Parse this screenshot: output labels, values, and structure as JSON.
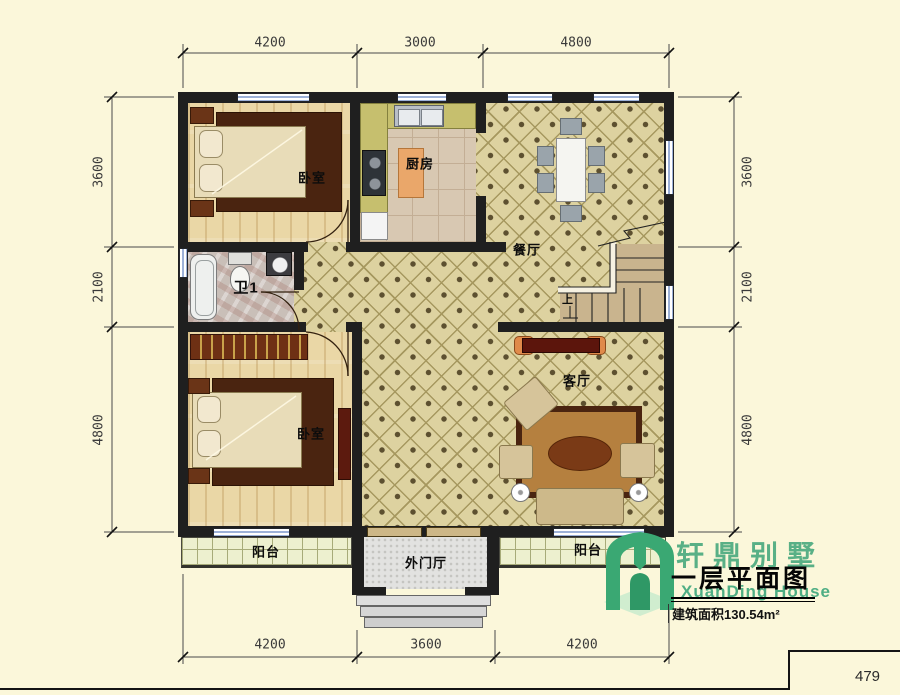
{
  "page": {
    "number": "479"
  },
  "title_block": {
    "brand_cn": "轩鼎别墅",
    "brand_en": "XuanDing House",
    "drawing_title": "一层平面图",
    "area_text": "建筑面积130.54m²"
  },
  "rooms": {
    "bedroom_top": "卧室",
    "kitchen": "厨房",
    "dining": "餐厅",
    "bath": "卫1",
    "bedroom_bottom": "卧室",
    "living": "客厅",
    "balcony_left": "阳台",
    "foyer": "外门厅",
    "balcony_right": "阳台"
  },
  "stairs": {
    "up_label": "上"
  },
  "dimensions": {
    "top": [
      "4200",
      "3000",
      "4800"
    ],
    "bottom": [
      "4200",
      "3600",
      "4200"
    ],
    "left": [
      "3600",
      "2100",
      "4800"
    ],
    "right": [
      "3600",
      "2100",
      "4800"
    ]
  },
  "colors": {
    "wall": "#1f1f1f",
    "tile_floor": "#ddd2a0",
    "brand_green": "#4fae84"
  }
}
